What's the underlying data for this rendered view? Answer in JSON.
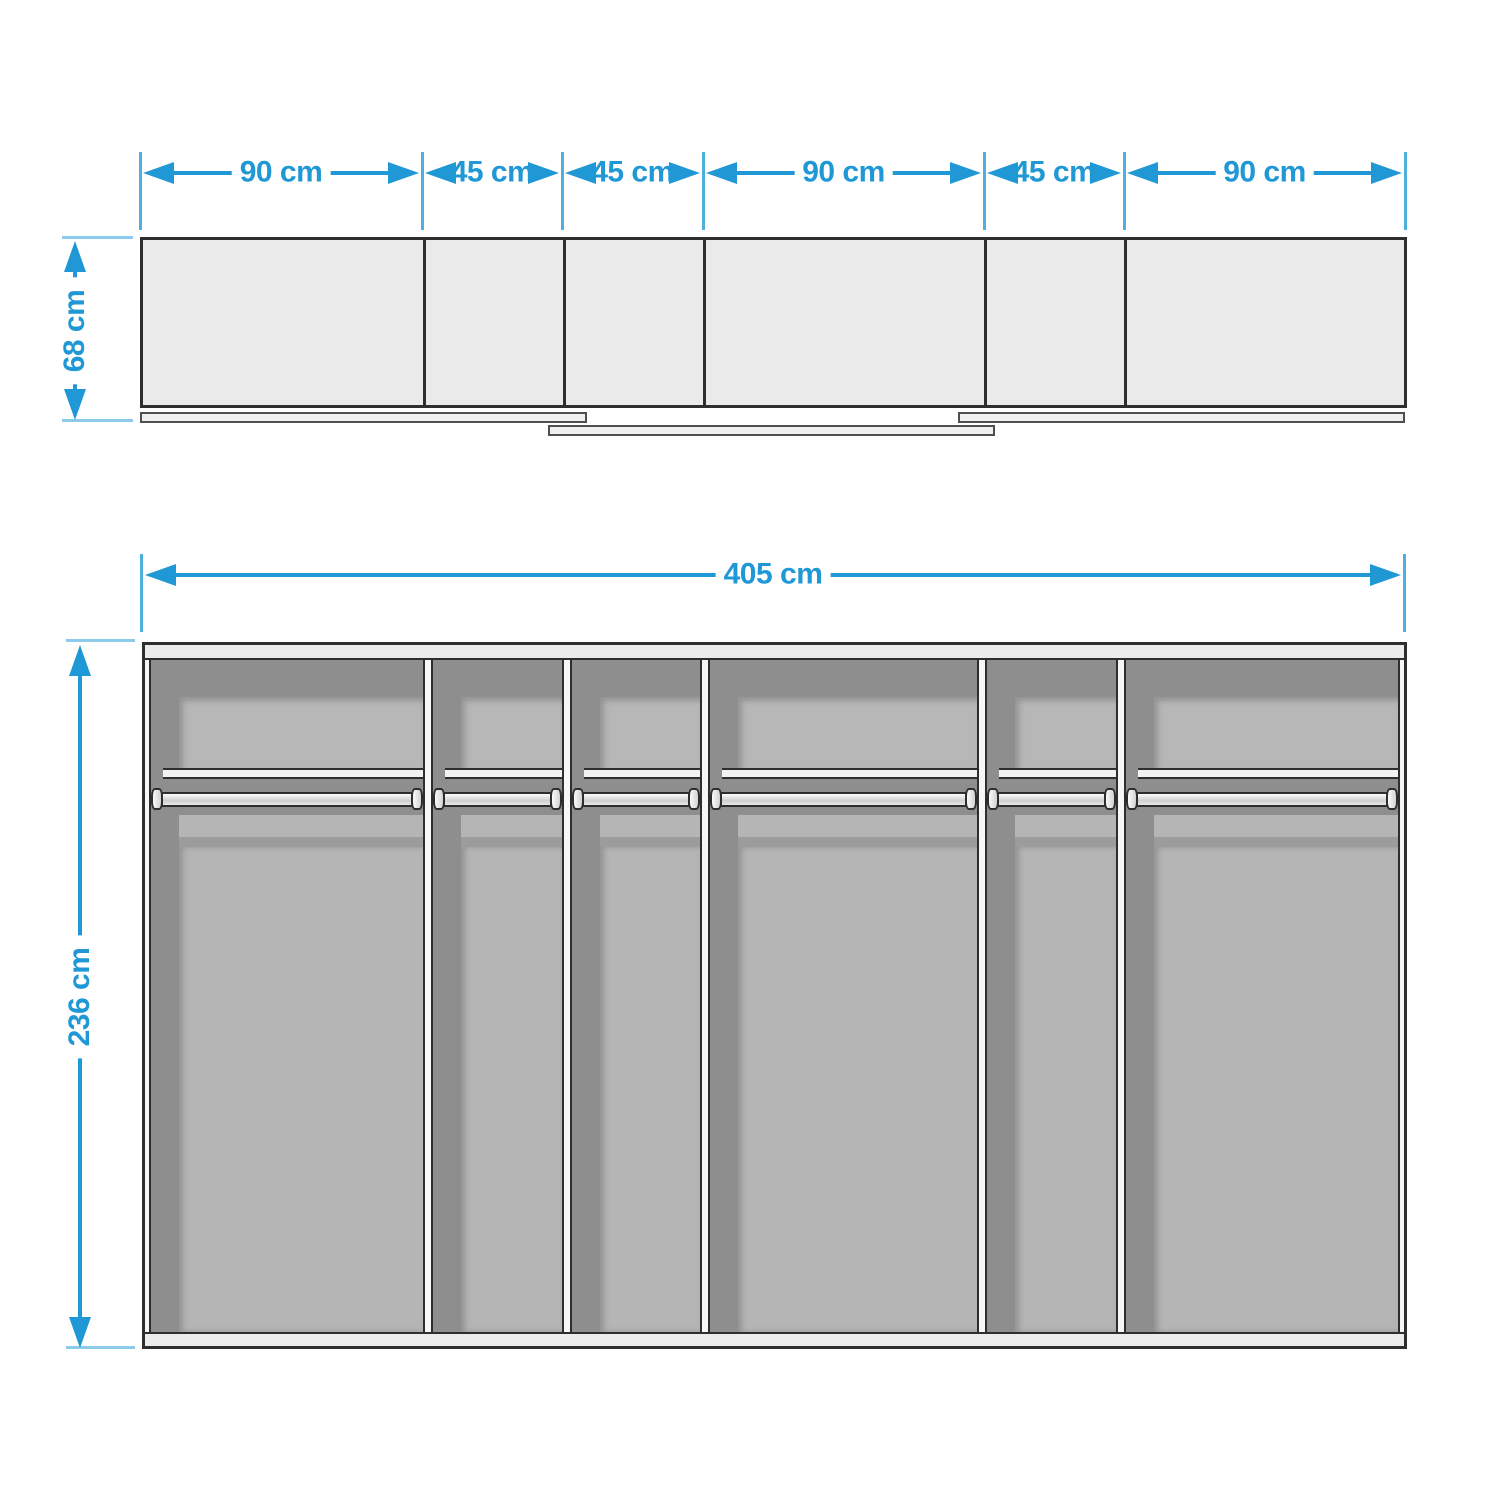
{
  "dimensions": {
    "top_segments": [
      {
        "label": "90 cm"
      },
      {
        "label": "45 cm"
      },
      {
        "label": "45 cm"
      },
      {
        "label": "90 cm"
      },
      {
        "label": "45 cm"
      },
      {
        "label": "90 cm"
      }
    ],
    "depth_label": "68 cm",
    "total_width_label": "405 cm",
    "height_label": "236 cm"
  },
  "colors": {
    "dimension_blue": "#2098D5",
    "tick_blue_light": "#8CCBEC",
    "outline_dark": "#2E2E2E",
    "carcass_light": "#ECECEC",
    "interior_dark": "#8E8E8E",
    "back_panel_light": "#B5B5B5"
  }
}
